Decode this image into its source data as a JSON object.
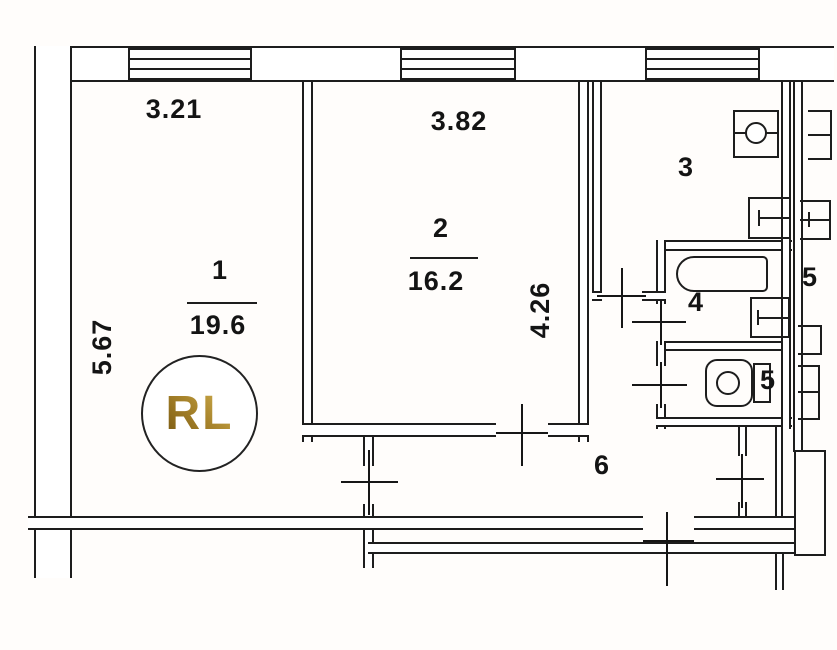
{
  "plan": {
    "type": "apartment floor plan (BTI scan)",
    "line_color": "#1d1d1d",
    "background": "#ffffff"
  },
  "logo": {
    "text": "RL",
    "gold_dark": "#76560f",
    "gold_mid": "#a8842c",
    "gold_light": "#d9b955"
  },
  "rooms": [
    {
      "number": "1",
      "area": "19.6"
    },
    {
      "number": "2",
      "area": "16.2"
    },
    {
      "number": "3"
    },
    {
      "number": "4"
    },
    {
      "number": "5"
    },
    {
      "number": "6"
    },
    {
      "number": "5"
    }
  ],
  "dimensions": [
    {
      "label": "3.21",
      "edge": "top",
      "room": "1"
    },
    {
      "label": "3.82",
      "edge": "top",
      "room": "2"
    },
    {
      "label": "5.67",
      "edge": "left",
      "room": "1"
    },
    {
      "label": "4.26",
      "edge": "right",
      "room": "2"
    }
  ],
  "fixtures": [
    "kitchen-sink",
    "stove",
    "bathtub",
    "washbasin",
    "toilet",
    "adjacent-fixture",
    "door-cross-marker",
    "window-triple-line"
  ]
}
